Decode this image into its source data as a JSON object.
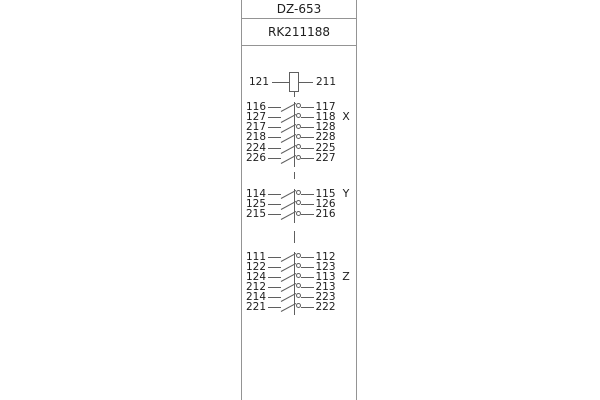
{
  "colors": {
    "panel_border": "#949494",
    "symbol_line": "#5f5f5f",
    "text": "#1e1e1e",
    "background": "#ffffff"
  },
  "header": {
    "model": "DZ-653",
    "code": "RK211188"
  },
  "coil": {
    "left_terminal": "121",
    "right_terminal": "211"
  },
  "contact_groups": [
    {
      "label": "X",
      "label_row_index": 1,
      "rows": [
        {
          "left": "116",
          "right": "117"
        },
        {
          "left": "127",
          "right": "118"
        },
        {
          "left": "217",
          "right": "128"
        },
        {
          "left": "218",
          "right": "228"
        },
        {
          "left": "224",
          "right": "225"
        },
        {
          "left": "226",
          "right": "227"
        }
      ]
    },
    {
      "label": "Y",
      "label_row_index": 0,
      "rows": [
        {
          "left": "114",
          "right": "115"
        },
        {
          "left": "125",
          "right": "126"
        },
        {
          "left": "215",
          "right": "216"
        }
      ]
    },
    {
      "label": "Z",
      "label_row_index": 2,
      "rows": [
        {
          "left": "111",
          "right": "112"
        },
        {
          "left": "122",
          "right": "123"
        },
        {
          "left": "124",
          "right": "113"
        },
        {
          "left": "212",
          "right": "213"
        },
        {
          "left": "214",
          "right": "223"
        },
        {
          "left": "221",
          "right": "222"
        }
      ]
    }
  ]
}
